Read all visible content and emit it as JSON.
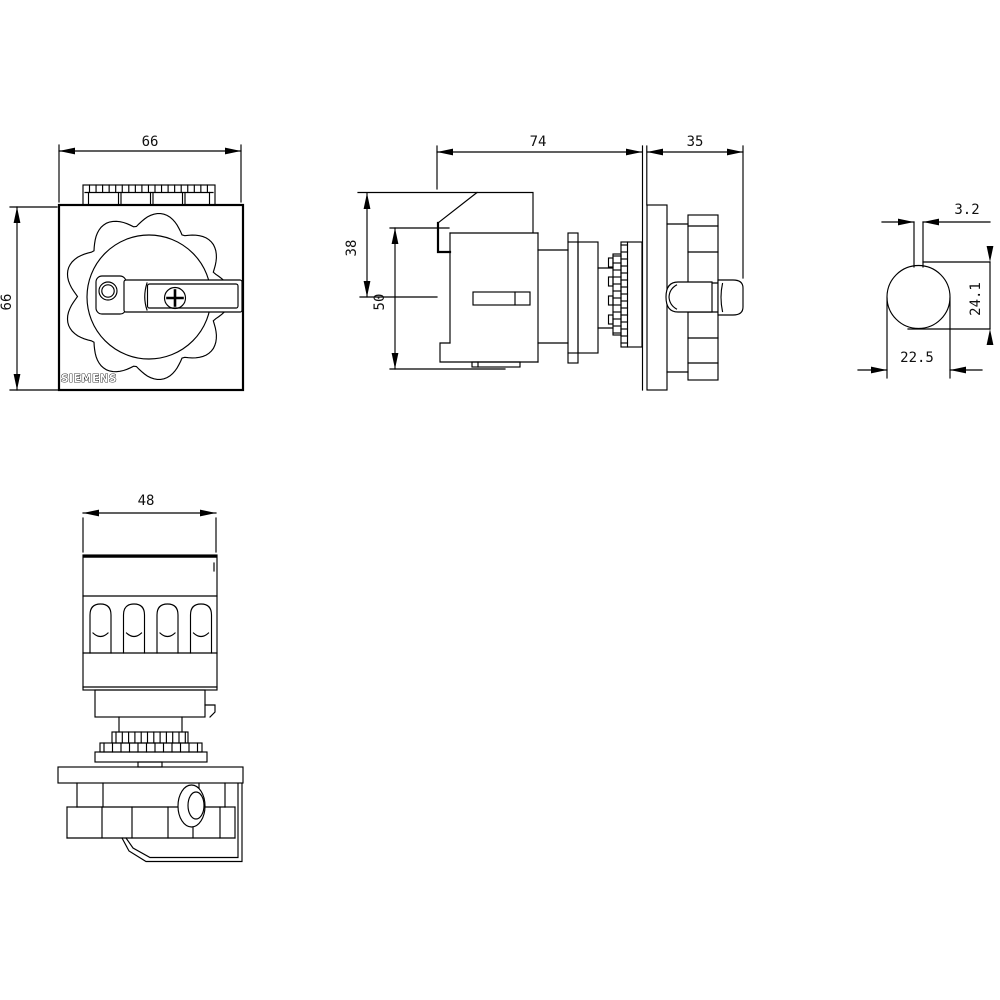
{
  "drawing": {
    "background_color": "#ffffff",
    "line_color": "#000000",
    "brand": "SIEMENS",
    "views": {
      "front_view": {
        "dim_width_mm": "66",
        "dim_height_mm": "66",
        "brand_label": "SIEMENS"
      },
      "side_view": {
        "dim_body_depth_mm": "74",
        "dim_handle_depth_mm": "35",
        "dim_upper_height_mm": "38",
        "dim_lower_height_mm": "50"
      },
      "shaft_section_view": {
        "dim_slot_width_mm": "3.2",
        "dim_shaft_height_mm": "24.1",
        "dim_shaft_width_mm": "22.5"
      },
      "bottom_view": {
        "dim_width_mm": "48"
      }
    }
  }
}
